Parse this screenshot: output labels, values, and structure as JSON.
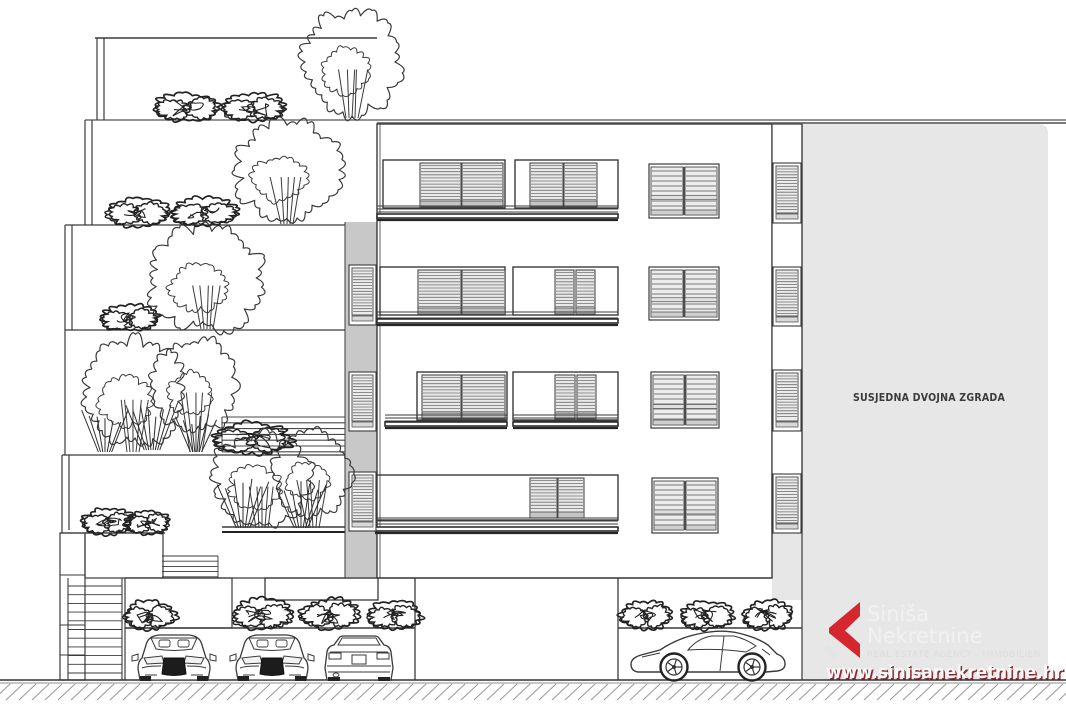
{
  "labels": {
    "neighbor_building": "SUSJEDNA DVOJNA ZGRADA"
  },
  "logo": {
    "chevron_icon": "logo-chevron-icon",
    "name_line1": "Siniša",
    "name_line2": "Nekretnine",
    "tagline": "REAL ESTATE AGENCY - IMMOBILIEN",
    "website": "www.sinisanekretnine.hr"
  },
  "colors": {
    "background": "#ffffff",
    "line": "#3a3a3a",
    "neighbor_fill": "#e7e7e7",
    "pillar_fill": "#c8c8c8",
    "louver_fill": "#e9e9e9",
    "shutter_fill": "#ececec",
    "hatch": "#9a9a9a",
    "logo_red": "#d6272e",
    "logo_text": "#f2f2f2"
  },
  "scene": {
    "type": "architectural-elevation",
    "window_rows": 4,
    "tree_count": 7,
    "bush_count": 15,
    "cars": [
      "sports-car-front",
      "sports-car-front",
      "sedan-rear",
      "sports-car-side"
    ]
  }
}
